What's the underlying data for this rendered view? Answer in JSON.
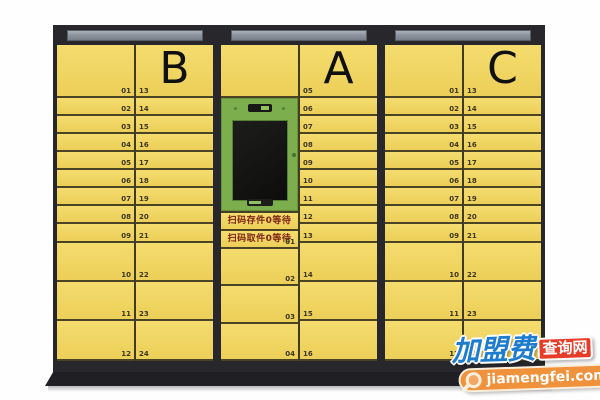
{
  "unit_name": "smart-parcel-locker",
  "cabinets": [
    {
      "name": "B",
      "letter": "B",
      "row_heights": [
        53,
        18,
        18,
        18,
        18,
        18,
        18,
        18,
        19,
        39,
        39,
        40
      ],
      "left_labels": [
        "01",
        "02",
        "03",
        "04",
        "05",
        "06",
        "07",
        "08",
        "09",
        "10",
        "11",
        "12"
      ],
      "right_labels": [
        "13",
        "14",
        "15",
        "16",
        "17",
        "18",
        "19",
        "20",
        "21",
        "22",
        "23",
        "24"
      ]
    },
    {
      "name": "A",
      "letter": "A",
      "row_heights": [
        53,
        18,
        18,
        18,
        18,
        18,
        18,
        18,
        19,
        39,
        39,
        40
      ],
      "right_labels": [
        "05",
        "06",
        "07",
        "08",
        "09",
        "10",
        "11",
        "12",
        "13",
        "14",
        "15",
        "16"
      ],
      "left": {
        "scan_deposit": "扫码存件0等待",
        "scan_pickup": "扫码取件0等待",
        "first_label": "01",
        "doors": [
          {
            "label": "02"
          },
          {
            "label": "03"
          },
          {
            "label": "04"
          }
        ]
      }
    },
    {
      "name": "C",
      "letter": "C",
      "row_heights": [
        53,
        18,
        18,
        18,
        18,
        18,
        18,
        18,
        19,
        39,
        39,
        40
      ],
      "left_labels": [
        "01",
        "02",
        "03",
        "04",
        "05",
        "06",
        "07",
        "08",
        "09",
        "10",
        "11",
        "12"
      ],
      "right_labels": [
        "13",
        "14",
        "15",
        "16",
        "17",
        "18",
        "19",
        "20",
        "21",
        "22",
        "23",
        "24"
      ]
    }
  ],
  "watermark": {
    "brand": "加盟费",
    "suffix": "查询网",
    "domain": "jiamengfei.com"
  },
  "colors": {
    "door_yellow": "#f0d663",
    "frame_dark": "#28282c",
    "row_line": "#4a4425",
    "sign_gray": "#8d949e",
    "console_green": "#7cae4d",
    "screen_black": "#121210",
    "scan_text_red": "#7c2315",
    "watermark_blue": "#1e7cce",
    "watermark_red": "#e63c28",
    "watermark_orange": "#f0913c"
  }
}
